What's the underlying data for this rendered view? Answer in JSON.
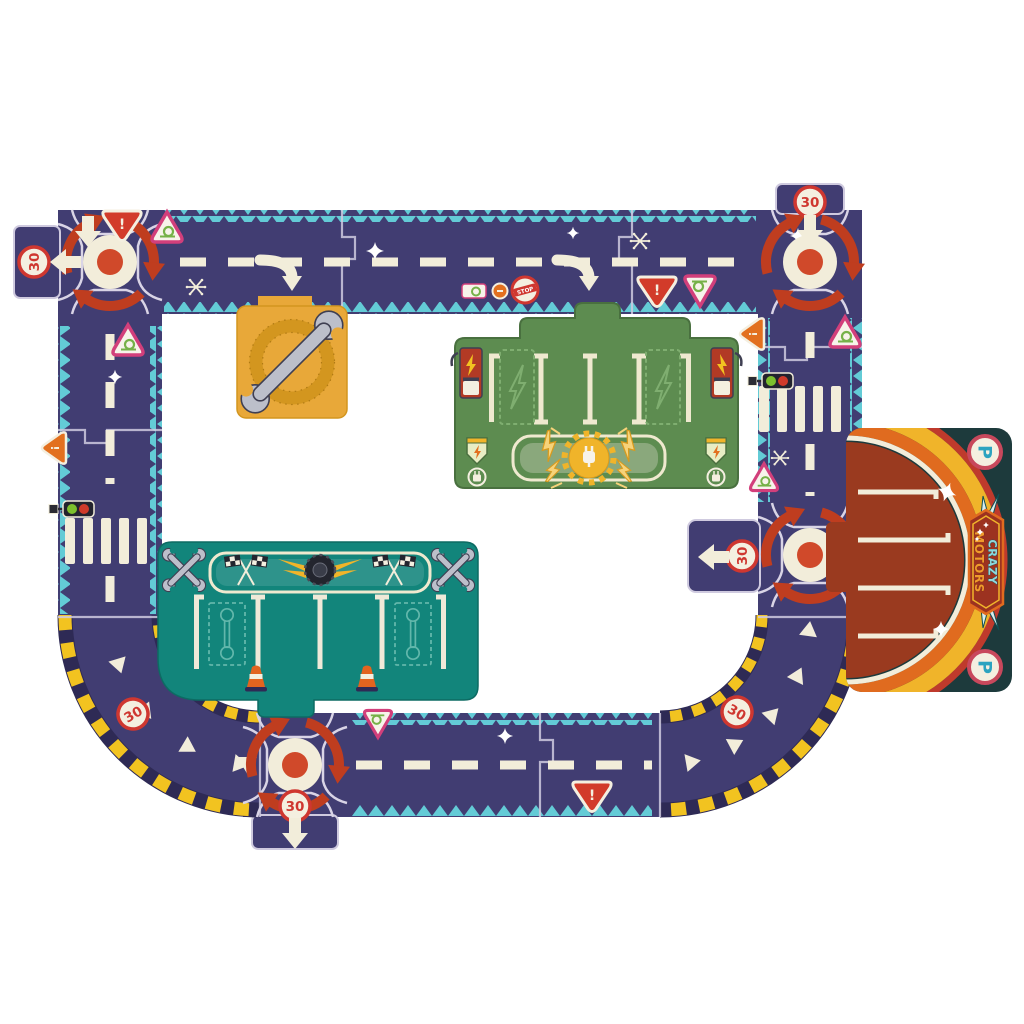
{
  "scene": {
    "description": "Crazy Motors giant road circuit puzzle laid out on white background",
    "background": "#ffffff"
  },
  "labels": {
    "speed_limit": "30",
    "parking": "P",
    "stop": "STOP",
    "warning_mark": "!",
    "brand_line1": "CRAZY",
    "brand_line2": "MOTORS"
  },
  "colors": {
    "road": "#413d72",
    "road_edge_zigzag": "#63cbd6",
    "marking_cream": "#f2edda",
    "roundabout_arrow_red": "#bf3d1f",
    "sign_red": "#cf3730",
    "sign_pink": "#d23f7b",
    "snail_green": "#76b148",
    "hazard_yellow": "#f2c320",
    "garage_yellow": "#e8a839",
    "station_green": "#5d8c50",
    "charger_red": "#b23a25",
    "pit_teal": "#12857b",
    "parking_background": "#1d3a3c",
    "parking_brown": "#9a3a1f",
    "arc_orange": "#e06b1f",
    "parking_letter": "#2ba3c0",
    "cone_orange": "#e2641f"
  },
  "pieces": [
    {
      "name": "roundabout-top-left",
      "kind": "roundabout puzzle piece",
      "markings": [
        "red circular arrows",
        "white center disc with red dot",
        "speed 30 sign",
        "left arrow stub",
        "down arrow",
        "red warning triangle"
      ]
    },
    {
      "name": "straight-road-top",
      "kind": "straight road pieces",
      "markings": [
        "dashed center line",
        "turn arrows toward garage and charging station",
        "snail warning triangles",
        "stop sign",
        "snail plate sign",
        "orange dot sign",
        "red warning triangle",
        "sparkles",
        "snowflakes"
      ]
    },
    {
      "name": "roundabout-top-right",
      "kind": "roundabout puzzle piece",
      "markings": [
        "speed 30 sign stub",
        "down arrow",
        "red circular arrows"
      ]
    },
    {
      "name": "road-right",
      "kind": "straight road piece",
      "markings": [
        "pedestrian crossing",
        "traffic light",
        "orange warning triangle",
        "snail triangles",
        "snowflake",
        "dashed center line"
      ]
    },
    {
      "name": "roundabout-middle-right",
      "kind": "roundabout puzzle piece",
      "markings": [
        "speed 30 sign stub",
        "left arrow",
        "red circular arrows"
      ]
    },
    {
      "name": "road-left",
      "kind": "straight road pieces",
      "markings": [
        "pedestrian crossing",
        "traffic light",
        "orange warning triangle",
        "snail triangle",
        "dashed center line",
        "sparkle"
      ]
    },
    {
      "name": "curve-bottom-left",
      "kind": "curved road piece",
      "markings": [
        "yellow and navy hazard kerbs",
        "white chevrons",
        "tilted speed 30 sign"
      ]
    },
    {
      "name": "roundabout-bottom",
      "kind": "roundabout puzzle piece",
      "markings": [
        "speed 30 sign stub",
        "down arrow",
        "white yield triangle",
        "red circular arrows"
      ]
    },
    {
      "name": "road-bottom",
      "kind": "straight road piece",
      "markings": [
        "dashed center line",
        "red warning triangle",
        "inverted snail triangle",
        "sparkle"
      ]
    },
    {
      "name": "curve-bottom-right",
      "kind": "curved road piece",
      "markings": [
        "yellow and navy hazard kerbs",
        "white chevrons",
        "tilted speed 30 sign"
      ]
    },
    {
      "name": "garage-piece",
      "kind": "repair garage pad",
      "markings": [
        "grey double-ended wrench across a gold ring"
      ]
    },
    {
      "name": "charging-station-piece",
      "kind": "electric charging station pad",
      "markings": [
        "four parking bays",
        "dashed lightning-bolt bays",
        "two red chargers with yellow bolts",
        "central banner with gear and plug",
        "yellow lightning bolts",
        "two corner badges with plug medallions"
      ]
    },
    {
      "name": "pit-stop-piece",
      "kind": "pit stop workshop pad",
      "markings": [
        "banner with checkered flags and winged tire",
        "two crossed-wrench icons",
        "four bays",
        "two dashed wrench bays",
        "two traffic cones"
      ]
    },
    {
      "name": "parking-piece",
      "kind": "parking lot pad",
      "markings": [
        "CRAZY MOTORS winged logo",
        "two P parking signs",
        "yellow orange and cream arcs",
        "rust parking area with four bays",
        "white stars"
      ]
    }
  ]
}
